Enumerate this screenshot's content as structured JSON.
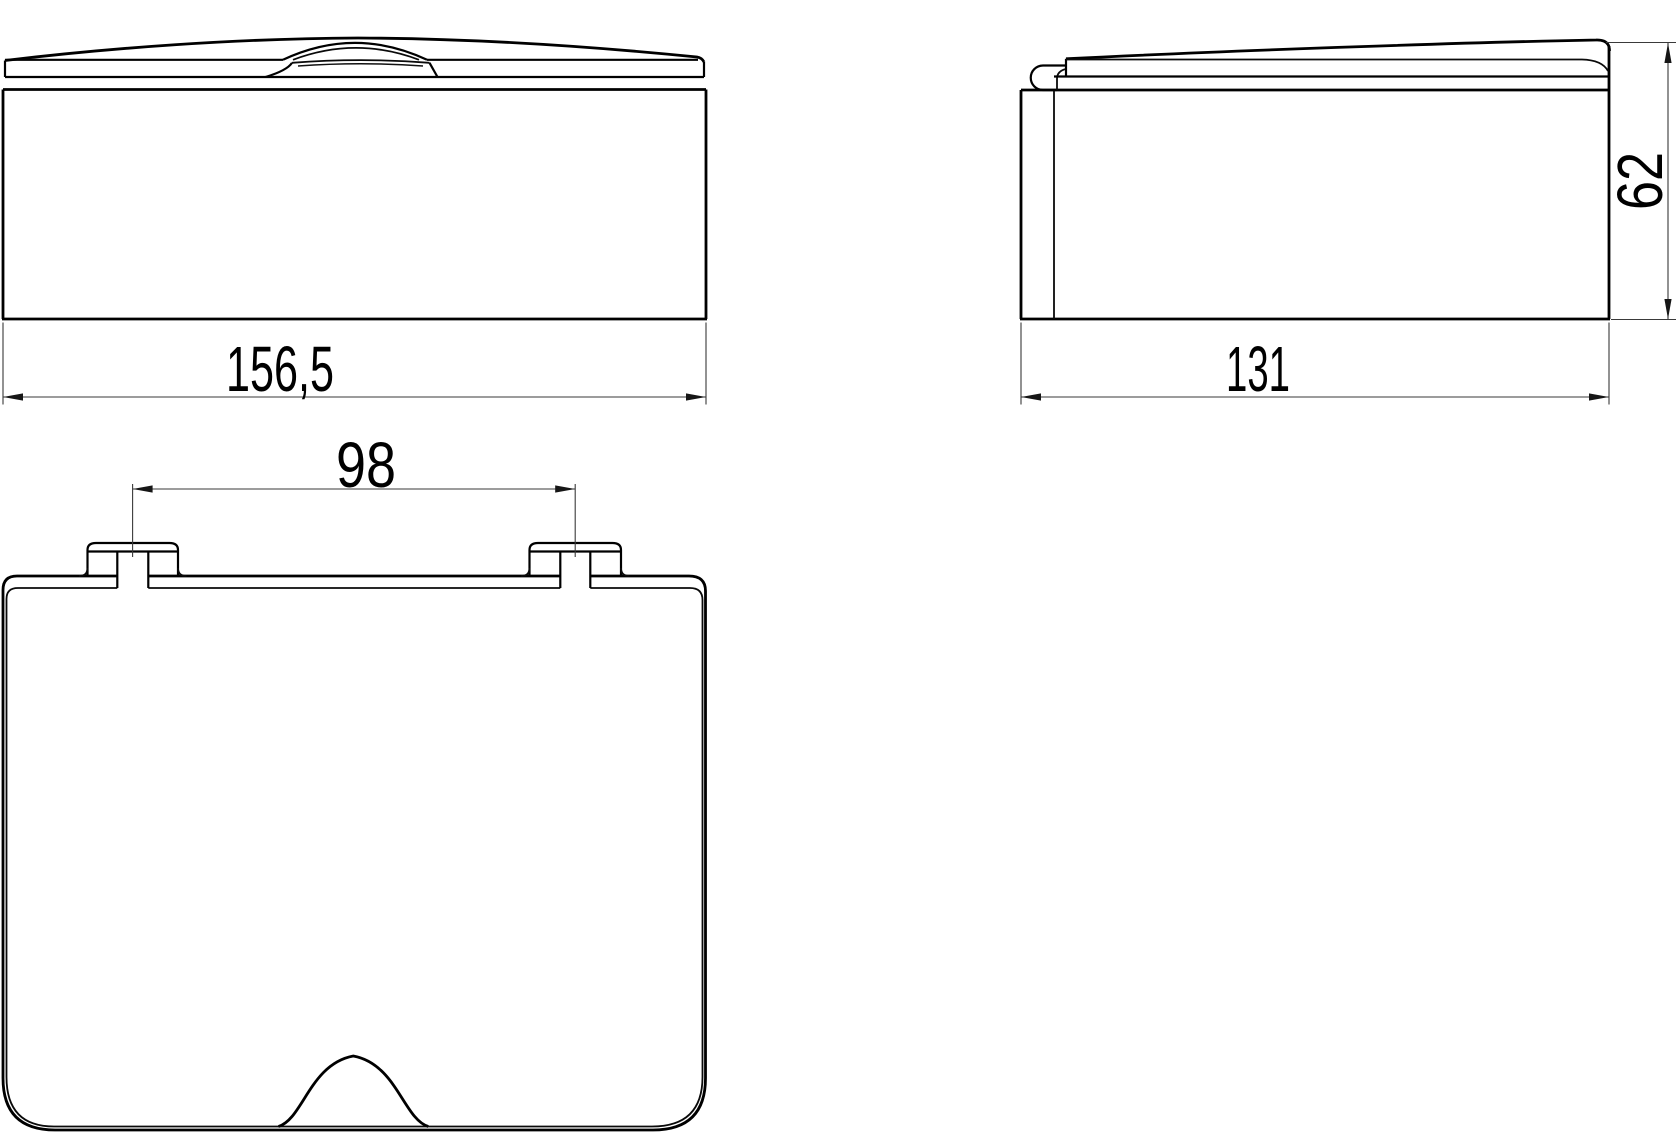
{
  "drawing": {
    "dimensions": {
      "front_width": "156,5",
      "side_depth": "131",
      "side_height": "62",
      "hinge_spacing": "98"
    },
    "colors": {
      "object_line": "#000000",
      "dimension_line": "#3a3a3a",
      "background": "#ffffff"
    }
  }
}
